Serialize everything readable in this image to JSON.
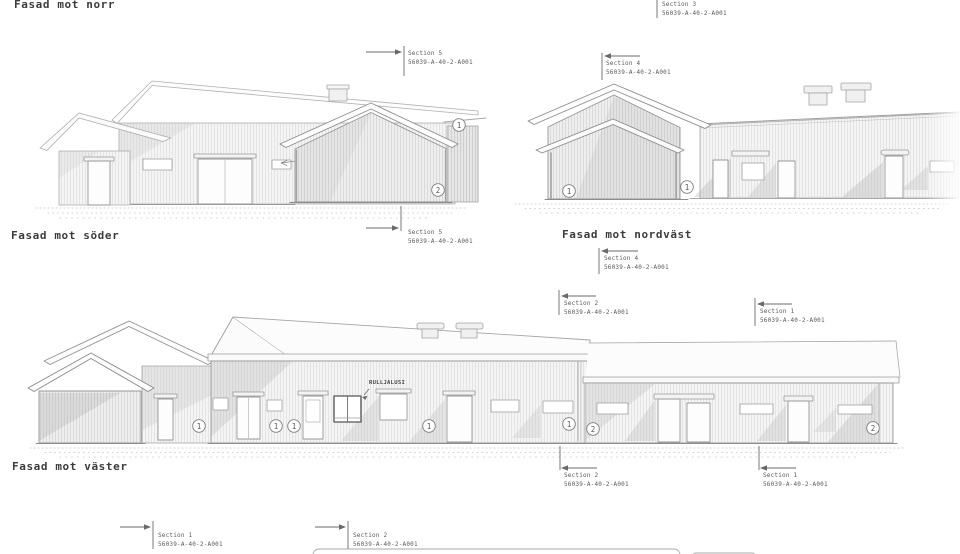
{
  "titles": {
    "north": "Fasad mot norr",
    "south": "Fasad mot söder",
    "northwest": "Fasad mot nordväst",
    "west": "Fasad mot väster"
  },
  "drawing_number": "56039-A-40-2-A001",
  "markers": {
    "sec5_top": {
      "label": "Section 5",
      "number": "56039-A-40-2-A001"
    },
    "sec5_bottom": {
      "label": "Section 5",
      "number": "56039-A-40-2-A001"
    },
    "sec3_top": {
      "label": "Section 3",
      "number": "56039-A-40-2-A001"
    },
    "sec4_top": {
      "label": "Section 4",
      "number": "56039-A-40-2-A001"
    },
    "sec4_bottom": {
      "label": "Section 4",
      "number": "56039-A-40-2-A001"
    },
    "sec2_west_top": {
      "label": "Section 2",
      "number": "56039-A-40-2-A001"
    },
    "sec1_west_top": {
      "label": "Section 1",
      "number": "56039-A-40-2-A001"
    },
    "sec2_west_bottom": {
      "label": "Section 2",
      "number": "56039-A-40-2-A001"
    },
    "sec1_west_bottom": {
      "label": "Section 1",
      "number": "56039-A-40-2-A001"
    },
    "sec1_strip": {
      "label": "Section 1",
      "number": "56039-A-40-2-A001"
    },
    "sec2_strip": {
      "label": "Section 2",
      "number": "56039-A-40-2-A001"
    }
  },
  "annotations": {
    "roller_shutter": "RULLJALUSI"
  },
  "keynotes": {
    "one": "1",
    "two": "2"
  },
  "colors": {
    "line": "#8e8e8e",
    "light_line": "#b8b8b8",
    "text": "#5a5a5a",
    "shadow": "#b3b3b3"
  }
}
